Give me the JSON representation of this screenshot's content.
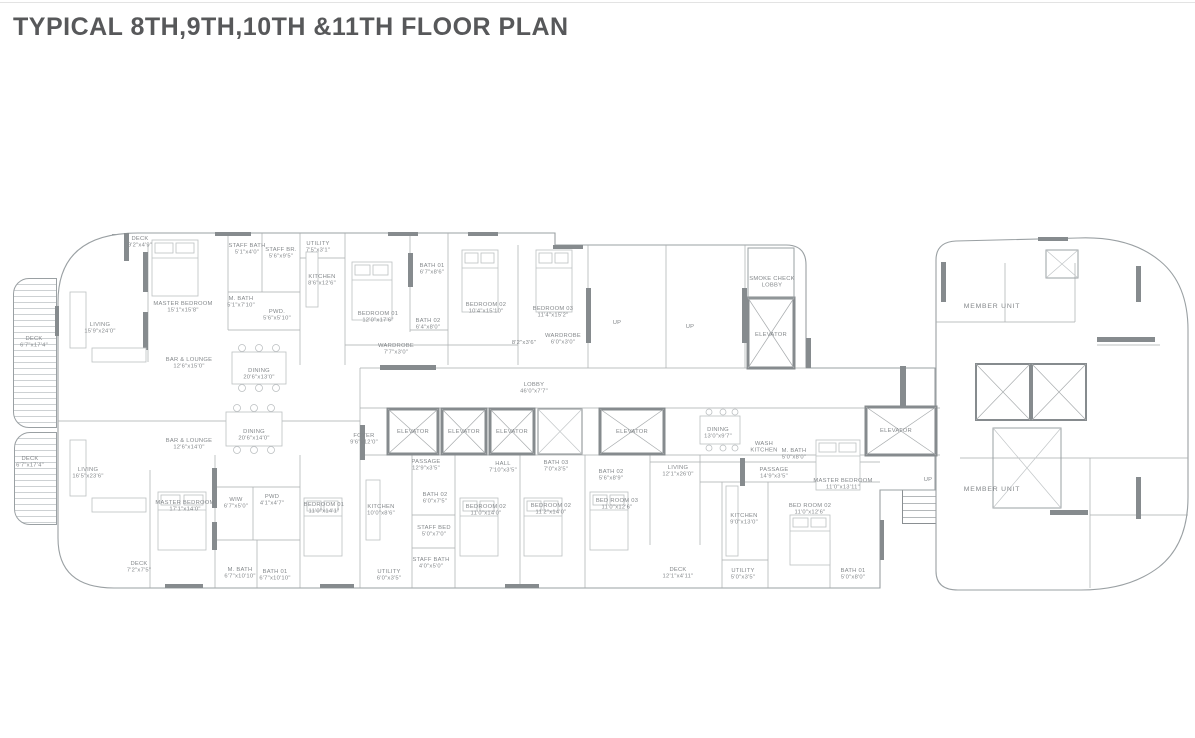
{
  "title": "TYPICAL 8TH,9TH,10TH &11TH FLOOR PLAN",
  "plan": {
    "rooms": [
      {
        "lines": [
          "DECK",
          "9'2\"x4'9\""
        ],
        "x": 140,
        "y": 240
      },
      {
        "lines": [
          "STAFF BATH",
          "5'1\"x4'0\""
        ],
        "x": 247,
        "y": 247
      },
      {
        "lines": [
          "STAFF BR.",
          "5'6\"x9'5\""
        ],
        "x": 281,
        "y": 251
      },
      {
        "lines": [
          "UTILITY",
          "7'5\"x3'1\""
        ],
        "x": 318,
        "y": 245
      },
      {
        "lines": [
          "MASTER BEDROOM",
          "15'1\"x15'8\""
        ],
        "x": 183,
        "y": 305
      },
      {
        "lines": [
          "LIVING",
          "15'9\"x24'0\""
        ],
        "x": 100,
        "y": 326
      },
      {
        "lines": [
          "DECK",
          "6'7\"x17'4\""
        ],
        "x": 34,
        "y": 340
      },
      {
        "lines": [
          "M. BATH",
          "5'1\"x7'10\""
        ],
        "x": 241,
        "y": 300
      },
      {
        "lines": [
          "PWD.",
          "5'6\"x5'10\""
        ],
        "x": 277,
        "y": 313
      },
      {
        "lines": [
          "KITCHEN",
          "8'6\"x12'6\""
        ],
        "x": 322,
        "y": 278
      },
      {
        "lines": [
          "BEDROOM 01",
          "12'0\"x17'6\""
        ],
        "x": 378,
        "y": 315
      },
      {
        "lines": [
          "WARDROBE",
          "7'7\"x3'0\""
        ],
        "x": 396,
        "y": 347
      },
      {
        "lines": [
          "BATH 01",
          "6'7\"x8'6\""
        ],
        "x": 432,
        "y": 267
      },
      {
        "lines": [
          "BATH 02",
          "6'4\"x8'0\""
        ],
        "x": 428,
        "y": 322
      },
      {
        "lines": [
          "BEDROOM 02",
          "10'4\"x15'10\""
        ],
        "x": 486,
        "y": 306
      },
      {
        "lines": [
          "8'2\"x3'6\""
        ],
        "x": 524,
        "y": 344
      },
      {
        "lines": [
          "WARDROBE",
          "6'0\"x3'0\""
        ],
        "x": 563,
        "y": 337
      },
      {
        "lines": [
          "BEDROOM 03",
          "11'4\"x15'2\""
        ],
        "x": 553,
        "y": 310
      },
      {
        "lines": [
          "UP"
        ],
        "x": 617,
        "y": 324
      },
      {
        "lines": [
          "UP"
        ],
        "x": 690,
        "y": 328
      },
      {
        "lines": [
          "SMOKE CHECK",
          "LOBBY"
        ],
        "x": 772,
        "y": 280
      },
      {
        "lines": [
          "ELEVATOR"
        ],
        "x": 771,
        "y": 336
      },
      {
        "lines": [
          "BAR & LOUNGE",
          "12'6\"x15'0\""
        ],
        "x": 189,
        "y": 361
      },
      {
        "lines": [
          "DINING",
          "20'6\"x13'0\""
        ],
        "x": 259,
        "y": 372
      },
      {
        "lines": [
          "LOBBY",
          "46'0\"x7'7\""
        ],
        "x": 534,
        "y": 386
      },
      {
        "lines": [
          "FOYER",
          "9'6\"x12'0\""
        ],
        "x": 364,
        "y": 437
      },
      {
        "lines": [
          "ELEVATOR"
        ],
        "x": 413,
        "y": 433
      },
      {
        "lines": [
          "ELEVATOR"
        ],
        "x": 464,
        "y": 433
      },
      {
        "lines": [
          "ELEVATOR"
        ],
        "x": 512,
        "y": 433
      },
      {
        "lines": [
          "ELEVATOR"
        ],
        "x": 632,
        "y": 433
      },
      {
        "lines": [
          "ELEVATOR"
        ],
        "x": 896,
        "y": 432
      },
      {
        "lines": [
          "DINING",
          "13'0\"x9'7\""
        ],
        "x": 718,
        "y": 431
      },
      {
        "lines": [
          "WASH",
          "KITCHEN"
        ],
        "x": 764,
        "y": 445
      },
      {
        "lines": [
          "M. BATH",
          "5'0\"x8'0\""
        ],
        "x": 794,
        "y": 452
      },
      {
        "lines": [
          "PASSAGE",
          "14'9\"x3'5\""
        ],
        "x": 774,
        "y": 471
      },
      {
        "lines": [
          "BAR & LOUNGE",
          "12'6\"x14'0\""
        ],
        "x": 189,
        "y": 442
      },
      {
        "lines": [
          "DINING",
          "20'6\"x14'0\""
        ],
        "x": 254,
        "y": 433
      },
      {
        "lines": [
          "LIVING",
          "16'5\"x23'6\""
        ],
        "x": 88,
        "y": 471
      },
      {
        "lines": [
          "DECK",
          "6'7\"x17'4\""
        ],
        "x": 30,
        "y": 460
      },
      {
        "lines": [
          "MASTER BEDROOM",
          "17'1\"x14'0\""
        ],
        "x": 185,
        "y": 504
      },
      {
        "lines": [
          "WIW",
          "6'7\"x5'0\""
        ],
        "x": 236,
        "y": 501
      },
      {
        "lines": [
          "PWD",
          "4'1\"x4'7\""
        ],
        "x": 272,
        "y": 498
      },
      {
        "lines": [
          "PASSAGE",
          "12'9\"x3'5\""
        ],
        "x": 426,
        "y": 463
      },
      {
        "lines": [
          "HALL",
          "7'10\"x3'5\""
        ],
        "x": 503,
        "y": 465
      },
      {
        "lines": [
          "BATH 03",
          "7'0\"x3'5\""
        ],
        "x": 556,
        "y": 464
      },
      {
        "lines": [
          "BATH 02",
          "5'6\"x8'9\""
        ],
        "x": 611,
        "y": 473
      },
      {
        "lines": [
          "LIVING",
          "12'1\"x26'0\""
        ],
        "x": 678,
        "y": 469
      },
      {
        "lines": [
          "BEDROOM 01",
          "11'0\"x14'1\""
        ],
        "x": 324,
        "y": 506
      },
      {
        "lines": [
          "KITCHEN",
          "10'0\"x8'6\""
        ],
        "x": 381,
        "y": 508
      },
      {
        "lines": [
          "BATH 02",
          "6'0\"x7'5\""
        ],
        "x": 435,
        "y": 496
      },
      {
        "lines": [
          "STAFF BED",
          "5'0\"x7'0\""
        ],
        "x": 434,
        "y": 529
      },
      {
        "lines": [
          "STAFF BATH",
          "4'0\"x5'0\""
        ],
        "x": 431,
        "y": 561
      },
      {
        "lines": [
          "UTILITY",
          "6'0\"x3'5\""
        ],
        "x": 389,
        "y": 573
      },
      {
        "lines": [
          "BEDROOM 02",
          "11'0\"x14'0\""
        ],
        "x": 486,
        "y": 508
      },
      {
        "lines": [
          "BEDROOM 02",
          "11'2\"x14'0\""
        ],
        "x": 551,
        "y": 507
      },
      {
        "lines": [
          "BED ROOM 03",
          "11'0\"x12'6\""
        ],
        "x": 617,
        "y": 502
      },
      {
        "lines": [
          "MASTER BEDROOM",
          "11'0\"x13'11\""
        ],
        "x": 843,
        "y": 482
      },
      {
        "lines": [
          "BED ROOM 02",
          "11'0\"x12'6\""
        ],
        "x": 810,
        "y": 507
      },
      {
        "lines": [
          "KITCHEN",
          "9'0\"x13'0\""
        ],
        "x": 744,
        "y": 517
      },
      {
        "lines": [
          "DECK",
          "7'2\"x7'5\""
        ],
        "x": 139,
        "y": 565
      },
      {
        "lines": [
          "M. BATH",
          "6'7\"x10'10\""
        ],
        "x": 240,
        "y": 571
      },
      {
        "lines": [
          "BATH 01",
          "6'7\"x10'10\""
        ],
        "x": 275,
        "y": 573
      },
      {
        "lines": [
          "DECK",
          "12'1\"x4'11\""
        ],
        "x": 678,
        "y": 571
      },
      {
        "lines": [
          "UTILITY",
          "5'0\"x3'5\""
        ],
        "x": 743,
        "y": 572
      },
      {
        "lines": [
          "BATH 01",
          "5'0\"x8'0\""
        ],
        "x": 853,
        "y": 572
      },
      {
        "lines": [
          "MEMBER UNIT"
        ],
        "cls": "unit",
        "x": 992,
        "y": 308
      },
      {
        "lines": [
          "MEMBER UNIT"
        ],
        "cls": "unit",
        "x": 992,
        "y": 491
      },
      {
        "lines": [
          "UP"
        ],
        "x": 928,
        "y": 481
      }
    ]
  }
}
